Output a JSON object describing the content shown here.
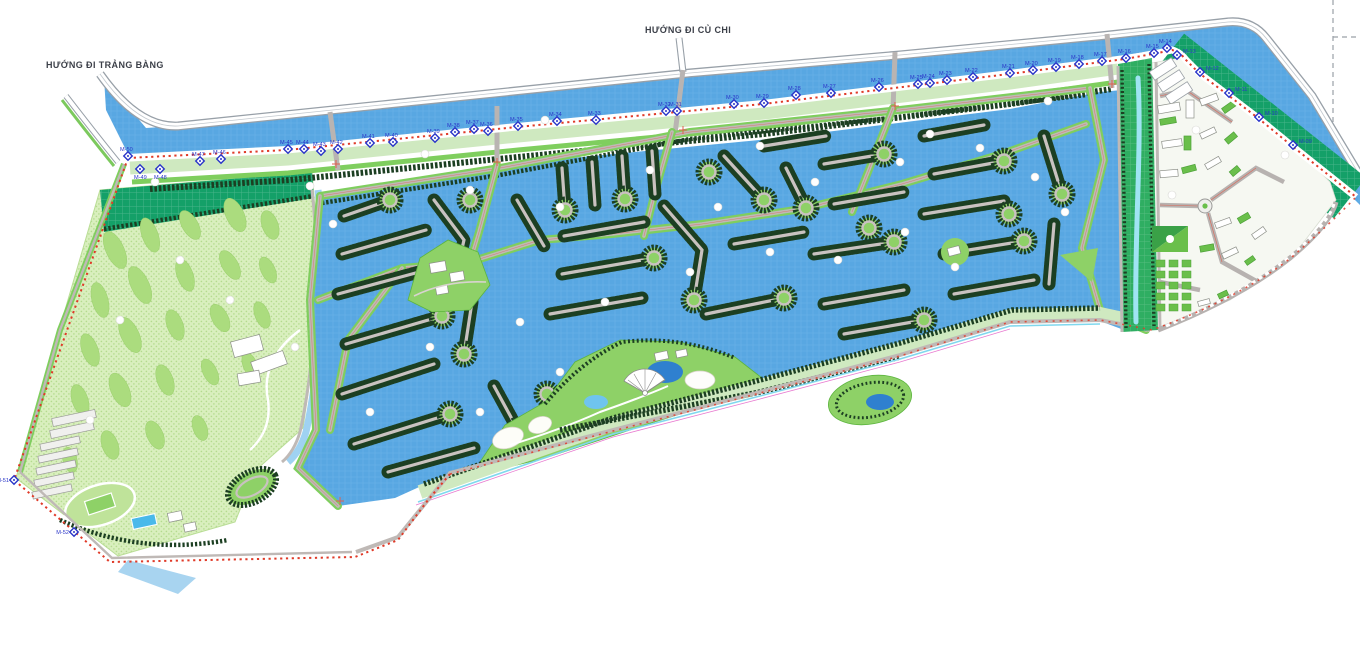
{
  "map_title": "Master plan – khu đô thị sinh thái (residential marina master plan)",
  "title_labels": {
    "cu_chi": "HƯỚNG ĐI CỦ CHI",
    "trang_bang": "HƯỚNG ĐI TRẢNG BÀNG"
  },
  "colors": {
    "water": "#58a7e2",
    "water_grid": "#79bbec",
    "canal": "#58a7e2",
    "lake": "#2f80cf",
    "stream": "#9fe4f2",
    "boundary_red": "#e03a28",
    "marker_blue": "#2a35c8",
    "golf": "#d9efbe",
    "golf_blob": "#abdc7e",
    "teal_strip": "#14a068",
    "corridor_green": "#2fae62",
    "tree_dark": "#1c3f22",
    "road_gray": "#c9c2c0",
    "spine_gray": "#bfb9b6",
    "verge_green": "#7fce5e",
    "park_green": "#8ed167",
    "district_bg": "#f6f8f2",
    "building_green": "#6abf4b",
    "buffer_pale": "#cfe9c0",
    "sand": "#fdfdf8"
  },
  "boundary_markers": [
    {
      "label": "M-52",
      "x": 74,
      "y": 532,
      "lp": "l"
    },
    {
      "label": "M-51",
      "x": 14,
      "y": 480,
      "lp": "l"
    },
    {
      "label": "M-50",
      "x": 128,
      "y": 156,
      "lp": "a"
    },
    {
      "label": "M-49",
      "x": 140,
      "y": 169,
      "lp": "b"
    },
    {
      "label": "M-48",
      "x": 160,
      "y": 169,
      "lp": "b"
    },
    {
      "label": "M-47",
      "x": 200,
      "y": 161,
      "lp": "a"
    },
    {
      "label": "M-46",
      "x": 221,
      "y": 159,
      "lp": "a"
    },
    {
      "label": "M-45",
      "x": 288,
      "y": 149,
      "lp": "a"
    },
    {
      "label": "M-44",
      "x": 304,
      "y": 149,
      "lp": "a"
    },
    {
      "label": "M-43",
      "x": 321,
      "y": 151,
      "lp": "a"
    },
    {
      "label": "M-42",
      "x": 338,
      "y": 149,
      "lp": "a"
    },
    {
      "label": "M-41",
      "x": 370,
      "y": 143,
      "lp": "a"
    },
    {
      "label": "M-40",
      "x": 393,
      "y": 142,
      "lp": "a"
    },
    {
      "label": "M-39",
      "x": 435,
      "y": 138,
      "lp": "a"
    },
    {
      "label": "M-38",
      "x": 455,
      "y": 132,
      "lp": "a"
    },
    {
      "label": "M-37",
      "x": 474,
      "y": 129,
      "lp": "a"
    },
    {
      "label": "M-36",
      "x": 488,
      "y": 131,
      "lp": "a"
    },
    {
      "label": "M-35",
      "x": 518,
      "y": 126,
      "lp": "a"
    },
    {
      "label": "M-34",
      "x": 557,
      "y": 121,
      "lp": "a"
    },
    {
      "label": "M-33",
      "x": 596,
      "y": 120,
      "lp": "a"
    },
    {
      "label": "M-32",
      "x": 666,
      "y": 111,
      "lp": "a"
    },
    {
      "label": "M-31",
      "x": 677,
      "y": 111,
      "lp": "a"
    },
    {
      "label": "M-30",
      "x": 734,
      "y": 104,
      "lp": "a"
    },
    {
      "label": "M-29",
      "x": 764,
      "y": 103,
      "lp": "a"
    },
    {
      "label": "M-28",
      "x": 796,
      "y": 95,
      "lp": "a"
    },
    {
      "label": "M-27",
      "x": 831,
      "y": 93,
      "lp": "a"
    },
    {
      "label": "M-26",
      "x": 879,
      "y": 87,
      "lp": "a"
    },
    {
      "label": "M-25",
      "x": 918,
      "y": 84,
      "lp": "a"
    },
    {
      "label": "M-24",
      "x": 930,
      "y": 83,
      "lp": "a"
    },
    {
      "label": "M-23",
      "x": 947,
      "y": 80,
      "lp": "a"
    },
    {
      "label": "M-22",
      "x": 973,
      "y": 77,
      "lp": "a"
    },
    {
      "label": "M-21",
      "x": 1010,
      "y": 73,
      "lp": "a"
    },
    {
      "label": "M-20",
      "x": 1033,
      "y": 70,
      "lp": "a"
    },
    {
      "label": "M-19",
      "x": 1056,
      "y": 67,
      "lp": "a"
    },
    {
      "label": "M-18",
      "x": 1079,
      "y": 64,
      "lp": "a"
    },
    {
      "label": "M-17",
      "x": 1102,
      "y": 61,
      "lp": "a"
    },
    {
      "label": "M-16",
      "x": 1126,
      "y": 58,
      "lp": "a"
    },
    {
      "label": "M-15",
      "x": 1154,
      "y": 53,
      "lp": "a"
    },
    {
      "label": "M-14",
      "x": 1167,
      "y": 48,
      "lp": "a"
    },
    {
      "label": "M-13",
      "x": 1177,
      "y": 55,
      "lp": "r"
    },
    {
      "label": "M-12",
      "x": 1200,
      "y": 72,
      "lp": "r"
    },
    {
      "label": "M-11",
      "x": 1229,
      "y": 93,
      "lp": "r"
    },
    {
      "label": "M-10",
      "x": 1259,
      "y": 117,
      "lp": "r"
    },
    {
      "label": "M-09",
      "x": 1293,
      "y": 145,
      "lp": "r"
    }
  ]
}
